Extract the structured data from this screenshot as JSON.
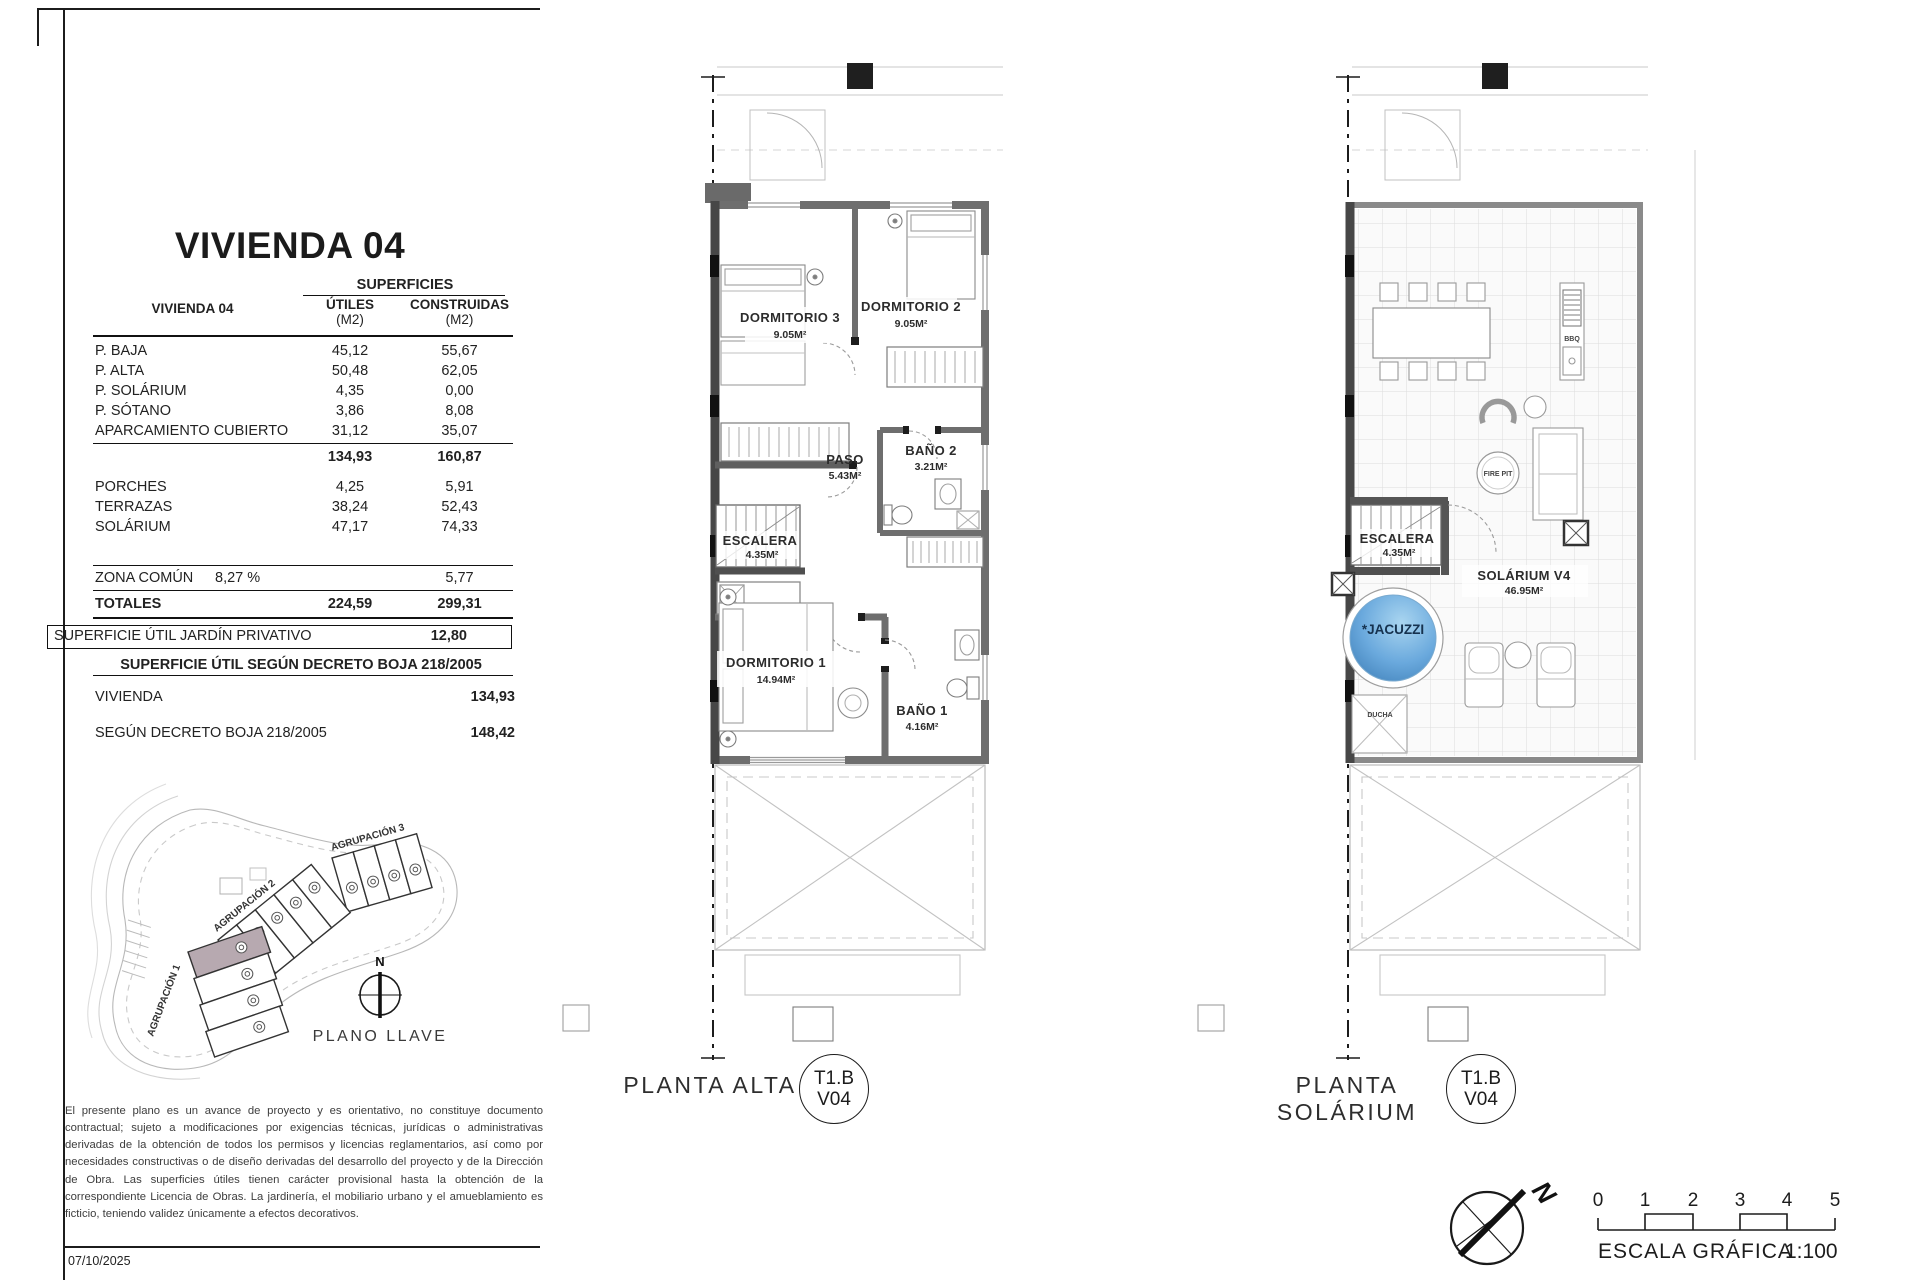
{
  "sheet": {
    "date": "07/10/2025"
  },
  "titleblock": {
    "title": "VIVIENDA 04",
    "superficies": "SUPERFICIES",
    "row_header": "VIVIENDA 04",
    "col_utiles": "ÚTILES",
    "col_construidas": "CONSTRUIDAS",
    "col_unit": "(M2)",
    "rows": [
      {
        "label": "P. BAJA",
        "utiles": "45,12",
        "construidas": "55,67"
      },
      {
        "label": "P. ALTA",
        "utiles": "50,48",
        "construidas": "62,05"
      },
      {
        "label": "P. SOLÁRIUM",
        "utiles": "4,35",
        "construidas": "0,00"
      },
      {
        "label": "P. SÓTANO",
        "utiles": "3,86",
        "construidas": "8,08"
      },
      {
        "label": "APARCAMIENTO CUBIERTO",
        "utiles": "31,12",
        "construidas": "35,07"
      }
    ],
    "subtotal": {
      "utiles": "134,93",
      "construidas": "160,87"
    },
    "rows2": [
      {
        "label": "PORCHES",
        "utiles": "4,25",
        "construidas": "5,91"
      },
      {
        "label": "TERRAZAS",
        "utiles": "38,24",
        "construidas": "52,43"
      },
      {
        "label": "SOLÁRIUM",
        "utiles": "47,17",
        "construidas": "74,33"
      }
    ],
    "zona_comun": {
      "label": "ZONA COMÚN",
      "pct": "8,27 %",
      "construidas": "5,77"
    },
    "totales": {
      "label": "TOTALES",
      "utiles": "224,59",
      "construidas": "299,31"
    },
    "jardin": {
      "label": "SUPERFICIE ÚTIL JARDÍN PRIVATIVO",
      "value": "12,80"
    },
    "decreto_header": "SUPERFICIE ÚTIL SEGÚN DECRETO BOJA 218/2005",
    "decreto_rows": [
      {
        "label": "VIVIENDA",
        "value": "134,93"
      },
      {
        "label": "SEGÚN DECRETO BOJA 218/2005",
        "value": "148,42"
      }
    ]
  },
  "key_plan": {
    "agrupacion1": "AGRUPACIÓN 1",
    "agrupacion2": "AGRUPACIÓN 2",
    "agrupacion3": "AGRUPACIÓN 3",
    "north": "N",
    "caption": "PLANO LLAVE"
  },
  "disclaimer": "El presente plano es un avance de proyecto y es orientativo, no constituye documento contractual; sujeto a modificaciones por exigencias técnicas, jurídicas o administrativas derivadas de la obtención de todos los permisos y licencias reglamentarios, así como por necesidades constructivas o de diseño derivadas del desarrollo del proyecto y de la Dirección de Obra. Las superficies útiles tienen carácter provisional hasta la obtención de la correspondiente Licencia de Obras. La jardinería, el mobiliario urbano y el amueblamiento es ficticio, teniendo validez únicamente a efectos decorativos.",
  "plan_alta": {
    "caption": "PLANTA ALTA",
    "badge_line1": "T1.B",
    "badge_line2": "V04",
    "rooms": [
      {
        "name": "DORMITORIO 3",
        "area": "9.05M²"
      },
      {
        "name": "DORMITORIO 2",
        "area": "9.05M²"
      },
      {
        "name": "BAÑO 2",
        "area": "3.21M²"
      },
      {
        "name": "PASO",
        "area": "5.43M²"
      },
      {
        "name": "ESCALERA",
        "area": "4.35M²"
      },
      {
        "name": "DORMITORIO 1",
        "area": "14.94M²"
      },
      {
        "name": "BAÑO 1",
        "area": "4.16M²"
      }
    ]
  },
  "plan_solarium": {
    "caption": "PLANTA SOLÁRIUM",
    "badge_line1": "T1.B",
    "badge_line2": "V04",
    "rooms": [
      {
        "name": "ESCALERA",
        "area": "4.35M²"
      },
      {
        "name": "SOLÁRIUM V4",
        "area": "46.95M²"
      }
    ],
    "jacuzzi_line1": "*JACUZZI",
    "jacuzzi_line2": "OPCIONAL",
    "bbq": "BBQ",
    "fire_pit": "FIRE PIT",
    "ducha": "DUCHA"
  },
  "scale_bar": {
    "caption": "ESCALA GRÁFICA",
    "ratio": "1:100",
    "ticks": [
      "0",
      "1",
      "2",
      "3",
      "4",
      "5"
    ],
    "north": "N"
  },
  "colors": {
    "wall_gray": "#6e6e6e",
    "party_wall": "#474747",
    "jacuzzi_blue": "#5b9fd8",
    "highlight_unit": "#b7a9b0"
  }
}
